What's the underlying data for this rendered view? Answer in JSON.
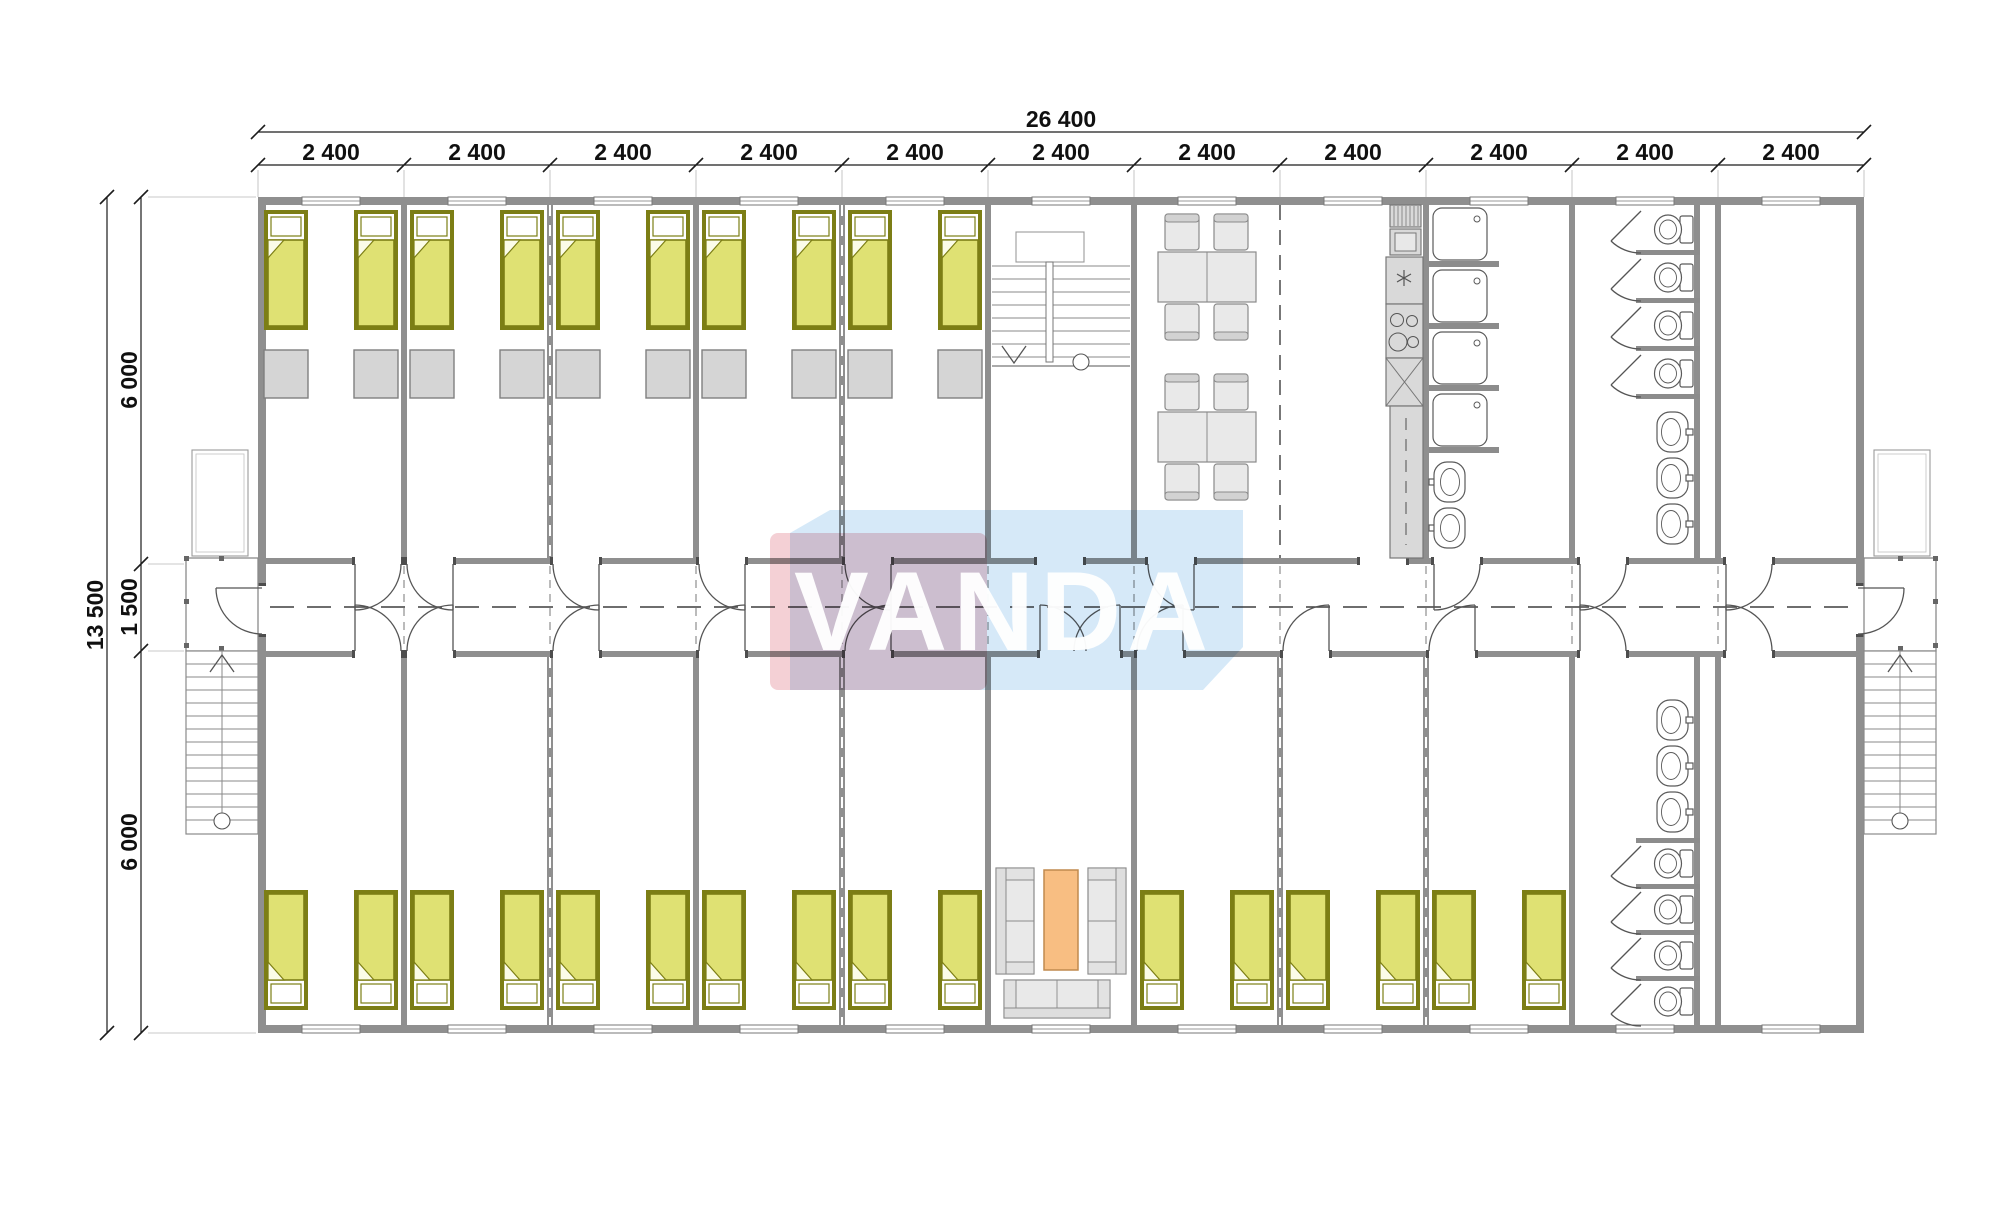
{
  "drawing": {
    "logo_text": "VANDA",
    "dim_total_width": "26 400",
    "dim_modules": [
      "2 400",
      "2 400",
      "2 400",
      "2 400",
      "2 400",
      "2 400",
      "2 400",
      "2 400",
      "2 400",
      "2 400",
      "2 400"
    ],
    "dim_total_height": "13 500",
    "dim_height_top": "6 000",
    "dim_height_mid": "1 500",
    "dim_height_bottom": "6 000"
  },
  "colors": {
    "wall": "#8f8f8f",
    "bed_fill": "#dfe173",
    "bed_border": "#7c7e15",
    "wardrobe": "#d5d5d5",
    "furniture": "#e9e9e9",
    "counter": "#d9d9d9",
    "coffee_table": "#f8be82",
    "logo_pink": "#f3c8ce",
    "logo_blue": "#cfe6f7",
    "logo_text": "#ffffff",
    "dim_text": "#101010"
  }
}
